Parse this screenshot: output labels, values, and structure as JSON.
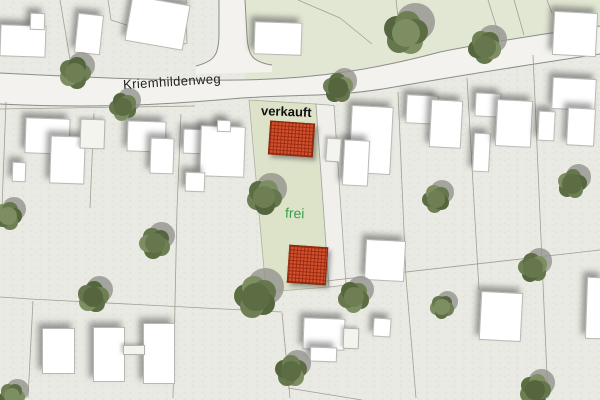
{
  "map": {
    "street_label": "Kriemhildenweg",
    "parcel": {
      "sold_label": "verkauft",
      "free_label": "frei"
    },
    "colors": {
      "background": "#e9eae3",
      "north_green_region": "#e2e7d3",
      "parcel_green": "#dce3c9",
      "parcel_path": "#f0efeb",
      "street_fill": "#f3f2ee",
      "street_edge": "#8c8c88",
      "building_fill": "#ffffff",
      "boundary_line": "#a39e93",
      "sold_text": "#101010",
      "free_text": "#3f9e4a",
      "red_fill": "#d2512e",
      "red_grid": "#96280e",
      "tree_shadow": "rgba(148,148,142,0.8)",
      "tree_greens": [
        "#6e7f53",
        "#5c6d44",
        "#7e8e63",
        "#66774d",
        "#55663f"
      ]
    },
    "geometry": {
      "north_green_region": "M245,0 L600,0 L600,26 C550,33 490,42 440,52 C380,68 320,79 245,80 Z",
      "street_band": "M0,73 C80,77 160,81 240,80 C320,79 380,68 440,52 C490,42 550,33 600,26 L600,54 C540,63 470,74 400,86 C330,99 300,93 230,99 C150,106 80,108 0,104 Z",
      "street_edge_north": "M0,73 C80,77 160,81 240,80 C320,79 380,68 440,52 C490,42 550,33 600,26",
      "street_edge_south": "M0,104 C80,108 150,106 230,99 C300,93 330,99 400,86 C470,74 540,63 600,54",
      "side_street_band": "M219,0 L245,0 L247,36 C248,55 252,62 272,65 L272,72 L196,74 L196,66 C215,61 218,55 219,36 Z",
      "side_street_edge_left": "M219,0 L219,36 C218,55 215,61 196,66",
      "side_street_edge_right": "M245,0 L247,36 C248,55 252,62 272,65",
      "parcel_green_poly": "M249,100 L316,104 L329,287 L266,292 Z",
      "parcel_path_poly": "M316,104 L334,105.5 L346,285 L329,287 Z"
    },
    "red_plots": [
      {
        "x": 269,
        "y": 122,
        "w": 43,
        "h": 32,
        "rot": 4
      },
      {
        "x": 288,
        "y": 246,
        "w": 37,
        "h": 36,
        "rot": 4
      }
    ],
    "buildings": [
      {
        "x": 0,
        "y": 25,
        "w": 44,
        "h": 30,
        "rot": 2
      },
      {
        "x": 30,
        "y": 13,
        "w": 13,
        "h": 15,
        "rot": 2
      },
      {
        "x": 76,
        "y": 14,
        "w": 24,
        "h": 38,
        "rot": 6
      },
      {
        "x": 128,
        "y": 0,
        "w": 57,
        "h": 44,
        "rot": 10
      },
      {
        "x": 254,
        "y": 22,
        "w": 46,
        "h": 31,
        "rot": 2
      },
      {
        "x": 553,
        "y": 12,
        "w": 42,
        "h": 42,
        "rot": 3
      },
      {
        "x": 25,
        "y": 118,
        "w": 43,
        "h": 34,
        "rot": 2
      },
      {
        "x": 50,
        "y": 136,
        "w": 33,
        "h": 46,
        "rot": 2
      },
      {
        "x": 12,
        "y": 162,
        "w": 12,
        "h": 18,
        "rot": 2
      },
      {
        "x": 80,
        "y": 119,
        "w": 23,
        "h": 28,
        "rot": 2,
        "light": true
      },
      {
        "x": 127,
        "y": 121,
        "w": 37,
        "h": 29,
        "rot": 2
      },
      {
        "x": 150,
        "y": 138,
        "w": 22,
        "h": 34,
        "rot": 2
      },
      {
        "x": 183,
        "y": 129,
        "w": 22,
        "h": 23,
        "rot": 2
      },
      {
        "x": 200,
        "y": 126,
        "w": 43,
        "h": 49,
        "rot": 2
      },
      {
        "x": 217,
        "y": 120,
        "w": 12,
        "h": 10,
        "rot": 2
      },
      {
        "x": 185,
        "y": 172,
        "w": 18,
        "h": 18,
        "rot": 2
      },
      {
        "x": 350,
        "y": 106,
        "w": 40,
        "h": 66,
        "rot": 3
      },
      {
        "x": 343,
        "y": 140,
        "w": 24,
        "h": 44,
        "rot": 3
      },
      {
        "x": 326,
        "y": 138,
        "w": 13,
        "h": 22,
        "rot": 4,
        "light": true
      },
      {
        "x": 406,
        "y": 95,
        "w": 30,
        "h": 27,
        "rot": 3
      },
      {
        "x": 430,
        "y": 100,
        "w": 30,
        "h": 46,
        "rot": 3
      },
      {
        "x": 473,
        "y": 133,
        "w": 15,
        "h": 37,
        "rot": 3
      },
      {
        "x": 475,
        "y": 93,
        "w": 24,
        "h": 22,
        "rot": 3
      },
      {
        "x": 496,
        "y": 100,
        "w": 34,
        "h": 45,
        "rot": 3
      },
      {
        "x": 538,
        "y": 111,
        "w": 15,
        "h": 28,
        "rot": 3
      },
      {
        "x": 552,
        "y": 78,
        "w": 42,
        "h": 30,
        "rot": 3
      },
      {
        "x": 567,
        "y": 108,
        "w": 26,
        "h": 36,
        "rot": 3
      },
      {
        "x": 42,
        "y": 328,
        "w": 31,
        "h": 44,
        "rot": 0
      },
      {
        "x": 93,
        "y": 327,
        "w": 30,
        "h": 53,
        "rot": 0
      },
      {
        "x": 143,
        "y": 323,
        "w": 30,
        "h": 59,
        "rot": 0
      },
      {
        "x": 123,
        "y": 345,
        "w": 20,
        "h": 8,
        "rot": 0,
        "light": true
      },
      {
        "x": 303,
        "y": 318,
        "w": 40,
        "h": 30,
        "rot": 2
      },
      {
        "x": 310,
        "y": 347,
        "w": 25,
        "h": 13,
        "rot": 2
      },
      {
        "x": 343,
        "y": 328,
        "w": 14,
        "h": 19,
        "rot": 2,
        "light": true
      },
      {
        "x": 373,
        "y": 318,
        "w": 16,
        "h": 17,
        "rot": 4
      },
      {
        "x": 365,
        "y": 240,
        "w": 38,
        "h": 39,
        "rot": 3
      },
      {
        "x": 480,
        "y": 292,
        "w": 40,
        "h": 47,
        "rot": 3
      },
      {
        "x": 586,
        "y": 277,
        "w": 14,
        "h": 60,
        "rot": 2
      }
    ],
    "trees": [
      {
        "x": 75,
        "y": 73,
        "r": 17
      },
      {
        "x": 123,
        "y": 107,
        "r": 15
      },
      {
        "x": 406,
        "y": 33,
        "r": 24
      },
      {
        "x": 485,
        "y": 47,
        "r": 18
      },
      {
        "x": 338,
        "y": 88,
        "r": 16
      },
      {
        "x": 264,
        "y": 197,
        "r": 19
      },
      {
        "x": 256,
        "y": 297,
        "r": 23
      },
      {
        "x": 8,
        "y": 216,
        "r": 15
      },
      {
        "x": 155,
        "y": 243,
        "r": 17
      },
      {
        "x": 93,
        "y": 297,
        "r": 17
      },
      {
        "x": 354,
        "y": 297,
        "r": 17
      },
      {
        "x": 291,
        "y": 371,
        "r": 17
      },
      {
        "x": 12,
        "y": 396,
        "r": 14
      },
      {
        "x": 533,
        "y": 268,
        "r": 16
      },
      {
        "x": 535,
        "y": 390,
        "r": 17
      },
      {
        "x": 436,
        "y": 199,
        "r": 15
      },
      {
        "x": 572,
        "y": 184,
        "r": 16
      },
      {
        "x": 442,
        "y": 307,
        "r": 13
      }
    ],
    "boundaries": [
      {
        "x1": 60,
        "y1": 0,
        "x2": 72,
        "y2": 71
      },
      {
        "x1": 108,
        "y1": 0,
        "x2": 111,
        "y2": 20
      },
      {
        "x1": 111,
        "y1": 20,
        "x2": 186,
        "y2": 44
      },
      {
        "x1": 186,
        "y1": 0,
        "x2": 187,
        "y2": 44
      },
      {
        "x1": 298,
        "y1": 0,
        "x2": 340,
        "y2": 18
      },
      {
        "x1": 340,
        "y1": 18,
        "x2": 372,
        "y2": 44
      },
      {
        "x1": 396,
        "y1": 0,
        "x2": 399,
        "y2": 25
      },
      {
        "x1": 488,
        "y1": 0,
        "x2": 500,
        "y2": 38
      },
      {
        "x1": 514,
        "y1": 0,
        "x2": 524,
        "y2": 35
      },
      {
        "x1": 547,
        "y1": 0,
        "x2": 552,
        "y2": 13
      },
      {
        "x1": 6,
        "y1": 102,
        "x2": 2,
        "y2": 207
      },
      {
        "x1": 94,
        "y1": 113,
        "x2": 90,
        "y2": 208
      },
      {
        "x1": 181,
        "y1": 114,
        "x2": 177,
        "y2": 209
      },
      {
        "x1": 398,
        "y1": 92,
        "x2": 406,
        "y2": 278
      },
      {
        "x1": 467,
        "y1": 78,
        "x2": 479,
        "y2": 290
      },
      {
        "x1": 533,
        "y1": 55,
        "x2": 548,
        "y2": 398
      },
      {
        "x1": 0,
        "y1": 297,
        "x2": 30,
        "y2": 299
      },
      {
        "x1": 30,
        "y1": 299,
        "x2": 282,
        "y2": 312
      },
      {
        "x1": 33,
        "y1": 301,
        "x2": 28,
        "y2": 398
      },
      {
        "x1": 177,
        "y1": 209,
        "x2": 173,
        "y2": 398
      },
      {
        "x1": 282,
        "y1": 313,
        "x2": 290,
        "y2": 398
      },
      {
        "x1": 300,
        "y1": 284,
        "x2": 600,
        "y2": 250
      },
      {
        "x1": 406,
        "y1": 278,
        "x2": 416,
        "y2": 398
      },
      {
        "x1": 288,
        "y1": 388,
        "x2": 362,
        "y2": 400
      },
      {
        "x1": 0,
        "y1": 109,
        "x2": 195,
        "y2": 106
      }
    ]
  }
}
